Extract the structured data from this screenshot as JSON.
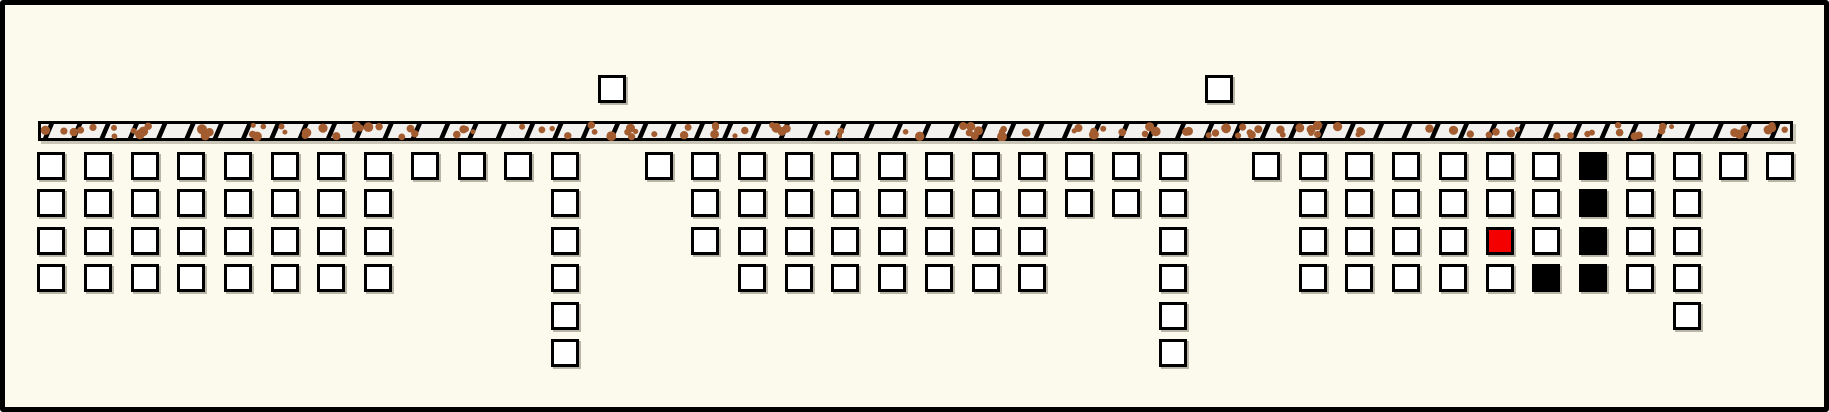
{
  "canvas": {
    "width": 1829,
    "height": 412,
    "background": "#fcfaec",
    "border_color": "#000000",
    "border_width": 5,
    "corner_radius": 3
  },
  "strip": {
    "x": 38,
    "y": 121,
    "width": 1755,
    "height": 20,
    "border_width": 3,
    "border_color": "#000000",
    "fill": "#f3f1ed",
    "tooth_color": "#000000",
    "tooth_start": 5,
    "tooth_spacing": 28.3,
    "tooth_width": 5,
    "tooth_lean": 6,
    "dot_color": "#a25c2f",
    "dot_count": 130,
    "dot_r_min": 2.5,
    "dot_r_max": 5.0,
    "dot_seed": 20240611
  },
  "grid": {
    "origin_x": 37,
    "origin_y": 152,
    "col_spacing": 46.73,
    "row_spacing": 37.38,
    "cell_size": 28,
    "cell_border": 3
  },
  "colors": {
    "w": "#ffffff",
    "b": "#000000",
    "r": "#f40000"
  },
  "top_cells": [
    {
      "col": 12,
      "y": 75
    },
    {
      "col": 25,
      "y": 75
    }
  ],
  "columns": [
    {
      "col": 0,
      "cells": "wwww"
    },
    {
      "col": 1,
      "cells": "wwww"
    },
    {
      "col": 2,
      "cells": "wwww"
    },
    {
      "col": 3,
      "cells": "wwww"
    },
    {
      "col": 4,
      "cells": "wwww"
    },
    {
      "col": 5,
      "cells": "wwww"
    },
    {
      "col": 6,
      "cells": "wwww"
    },
    {
      "col": 7,
      "cells": "wwww"
    },
    {
      "col": 8,
      "cells": "w"
    },
    {
      "col": 9,
      "cells": "w"
    },
    {
      "col": 10,
      "cells": "w"
    },
    {
      "col": 11,
      "cells": "wwwwww"
    },
    {
      "col": 12,
      "cells": ""
    },
    {
      "col": 13,
      "cells": "w"
    },
    {
      "col": 14,
      "cells": "www"
    },
    {
      "col": 15,
      "cells": "wwww"
    },
    {
      "col": 16,
      "cells": "wwww"
    },
    {
      "col": 17,
      "cells": "wwww"
    },
    {
      "col": 18,
      "cells": "wwww"
    },
    {
      "col": 19,
      "cells": "wwww"
    },
    {
      "col": 20,
      "cells": "wwww"
    },
    {
      "col": 21,
      "cells": "wwww"
    },
    {
      "col": 22,
      "cells": "ww"
    },
    {
      "col": 23,
      "cells": "ww"
    },
    {
      "col": 24,
      "cells": "wwwwww"
    },
    {
      "col": 25,
      "cells": ""
    },
    {
      "col": 26,
      "cells": "w"
    },
    {
      "col": 27,
      "cells": "wwww"
    },
    {
      "col": 28,
      "cells": "wwww"
    },
    {
      "col": 29,
      "cells": "wwww"
    },
    {
      "col": 30,
      "cells": "wwww"
    },
    {
      "col": 31,
      "cells": "wwrw"
    },
    {
      "col": 32,
      "cells": "wwwb"
    },
    {
      "col": 33,
      "cells": "bbbb"
    },
    {
      "col": 34,
      "cells": "wwww"
    },
    {
      "col": 35,
      "cells": "wwwww"
    },
    {
      "col": 36,
      "cells": "w"
    },
    {
      "col": 37,
      "cells": "w"
    }
  ]
}
